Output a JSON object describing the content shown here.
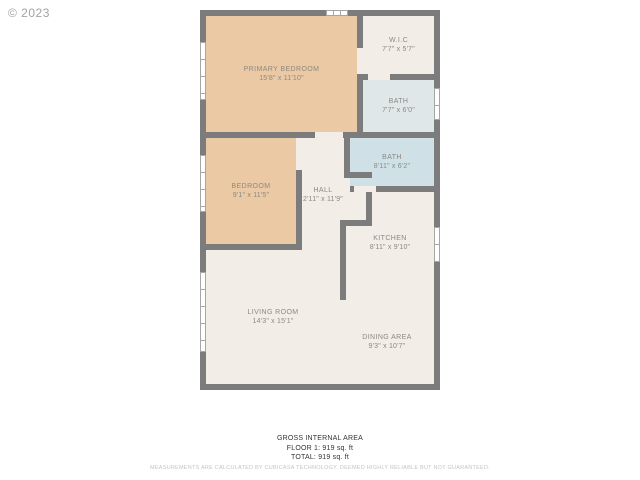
{
  "copyright": "© 2023",
  "colors": {
    "wall": "#7c7c7c",
    "bedroom_fill": "#ebc9a4",
    "common_fill": "#f2ede7",
    "small_bath_fill": "#dfe7e9",
    "large_bath_fill": "#cfe1e7",
    "label_text": "#8e8881",
    "window_fill": "#ffffff"
  },
  "rooms": [
    {
      "name": "PRIMARY BEDROOM",
      "dims": "15'8\" x 11'10\""
    },
    {
      "name": "W.I.C",
      "dims": "7'7\" x 5'7\""
    },
    {
      "name": "BATH",
      "dims": "7'7\" x 6'0\""
    },
    {
      "name": "BEDROOM",
      "dims": "9'1\" x 11'5\""
    },
    {
      "name": "HALL",
      "dims": "2'11\" x 11'9\""
    },
    {
      "name": "BATH",
      "dims": "8'11\" x 6'2\""
    },
    {
      "name": "KITCHEN",
      "dims": "8'11\" x 9'10\""
    },
    {
      "name": "LIVING ROOM",
      "dims": "14'3\" x 15'1\""
    },
    {
      "name": "DINING AREA",
      "dims": "9'3\" x 10'7\""
    }
  ],
  "footer": {
    "title": "GROSS INTERNAL AREA",
    "floor_line": "FLOOR 1: 919 sq. ft",
    "total_line": "TOTAL: 919 sq. ft",
    "disclaimer": "MEASUREMENTS ARE CALCULATED BY CUBICASA TECHNOLOGY. DEEMED HIGHLY RELIABLE BUT NOT GUARANTEED."
  }
}
